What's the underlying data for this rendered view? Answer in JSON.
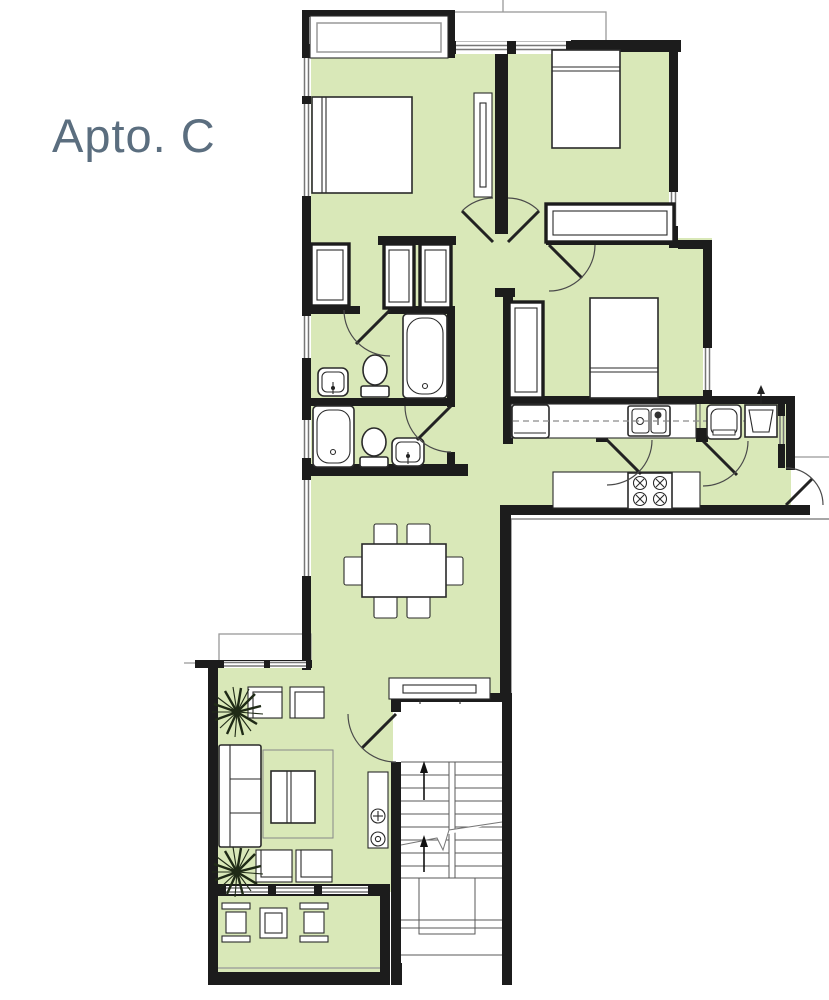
{
  "page": {
    "title": "Apto. C"
  },
  "colors": {
    "background": "#ffffff",
    "room_fill": "#d9e8b8",
    "wall": "#1c1c1c",
    "outline": "#2a2a2a",
    "detail_gray": "#999999",
    "title": "#5b6e7f",
    "plant": "#1f2a16"
  }
}
